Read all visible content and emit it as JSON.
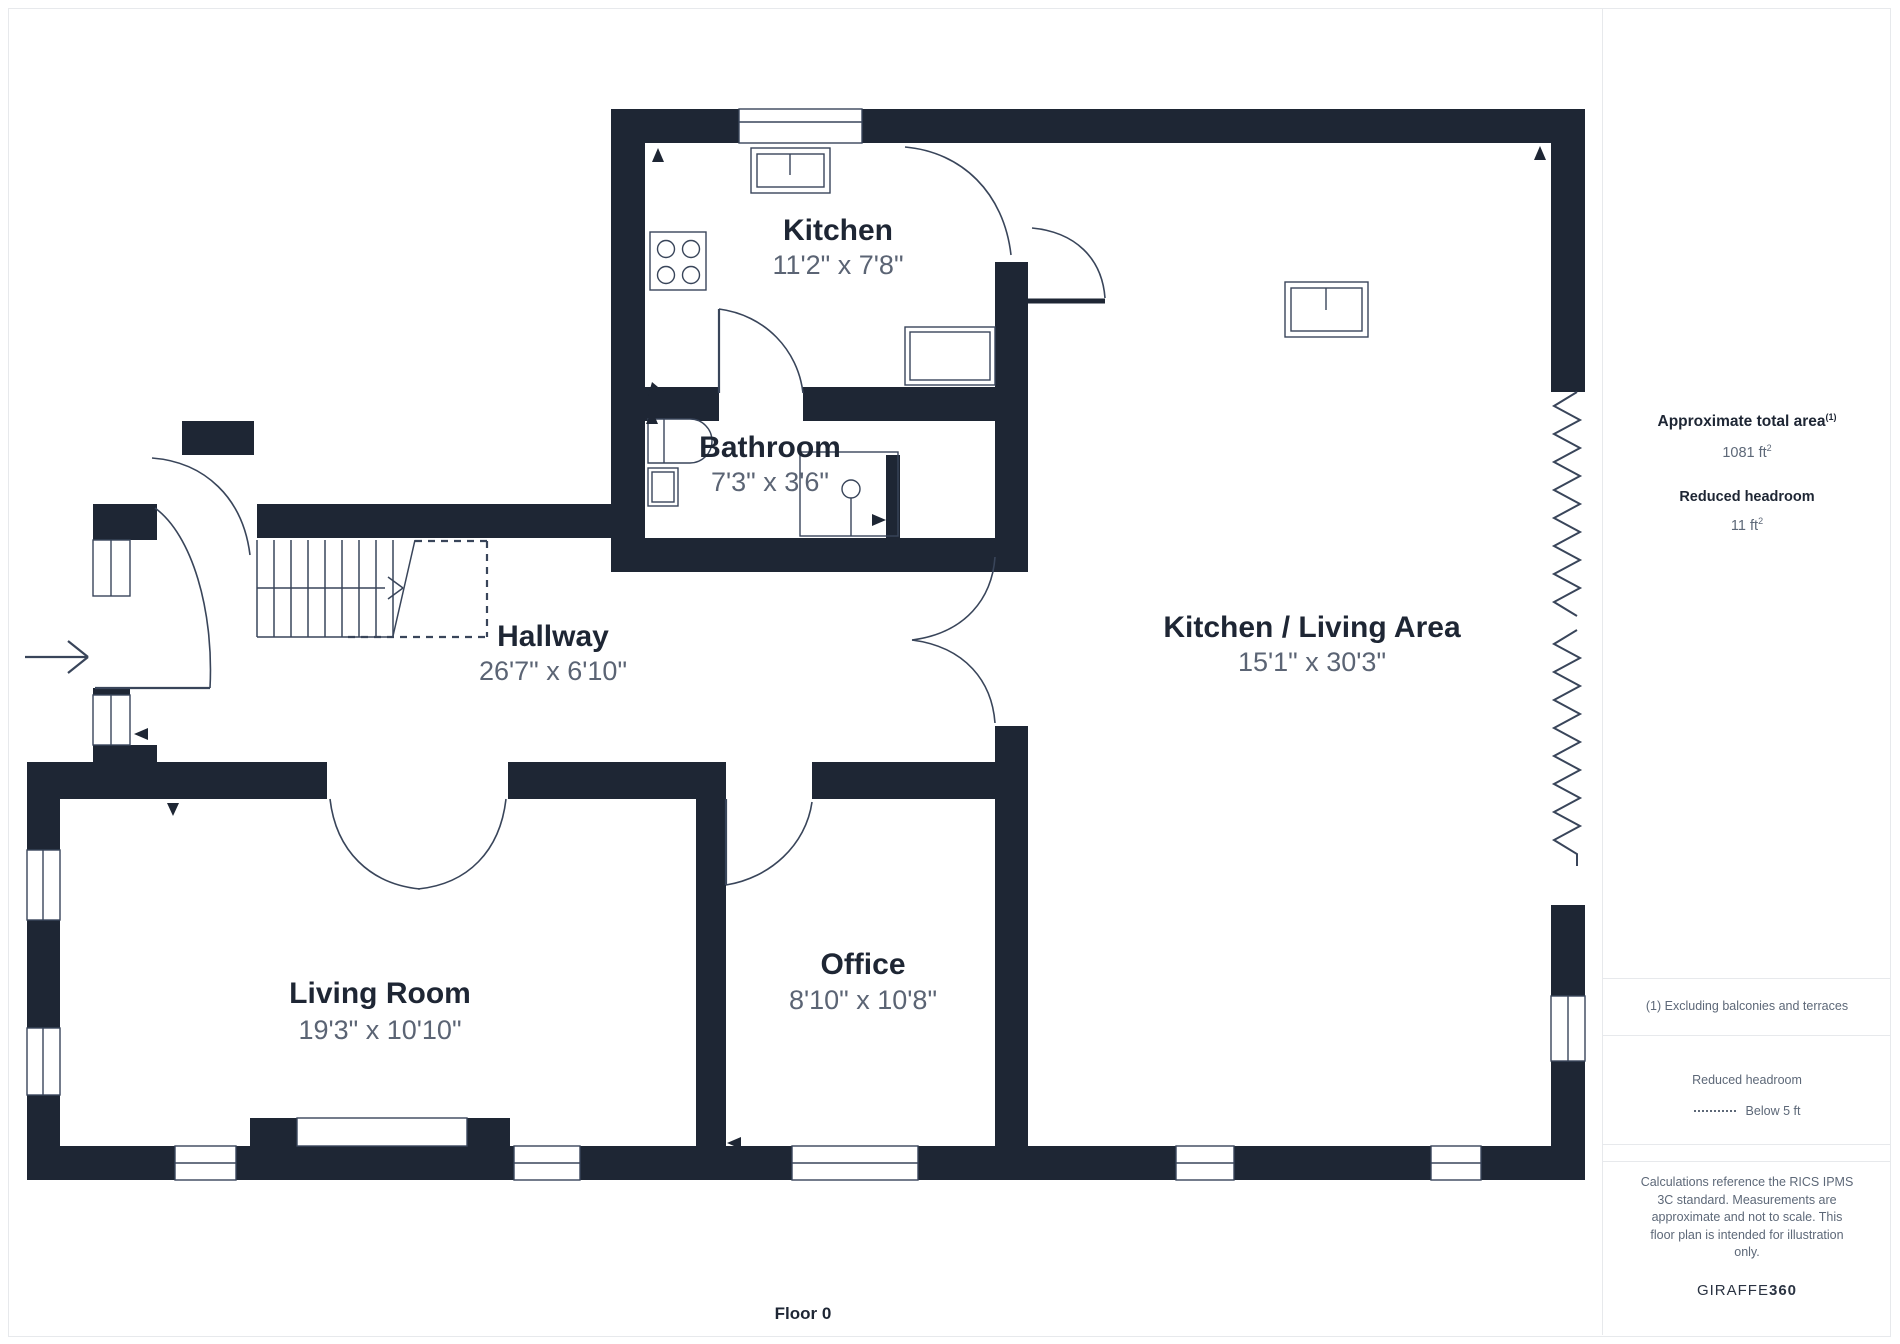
{
  "colors": {
    "wall": "#1e2634",
    "line": "#39455a",
    "dims_text": "#5b6474",
    "sidebar_text": "#5d6878",
    "divider": "#e7e9ec"
  },
  "rooms": [
    {
      "name": "Kitchen",
      "dims": "11'2\" x 7'8\""
    },
    {
      "name": "Bathroom",
      "dims": "7'3\" x 3'6\""
    },
    {
      "name": "Hallway",
      "dims": "26'7\" x 6'10\""
    },
    {
      "name": "Kitchen / Living Area",
      "dims": "15'1\" x 30'3\""
    },
    {
      "name": "Living Room",
      "dims": "19'3\" x 10'10\""
    },
    {
      "name": "Office",
      "dims": "8'10\" x 10'8\""
    }
  ],
  "sidebar": {
    "total_area_label": "Approximate total area",
    "total_area_note_sup": "(1)",
    "total_area_value": "1081 ft",
    "total_area_value_sup": "2",
    "reduced_headroom_label": "Reduced headroom",
    "reduced_headroom_value": "11 ft",
    "reduced_headroom_value_sup": "2",
    "footnote": "(1) Excluding balconies and terraces",
    "legend_label": "Reduced headroom",
    "legend_value": "Below 5 ft",
    "disclaimer_lines": [
      "Calculations reference the RICS IPMS",
      "3C standard. Measurements are",
      "approximate and not to scale. This",
      "floor plan is intended for illustration",
      "only."
    ],
    "brand_regular": "GIRAFFE",
    "brand_bold": "360"
  },
  "footer": {
    "floor_label": "Floor 0"
  }
}
